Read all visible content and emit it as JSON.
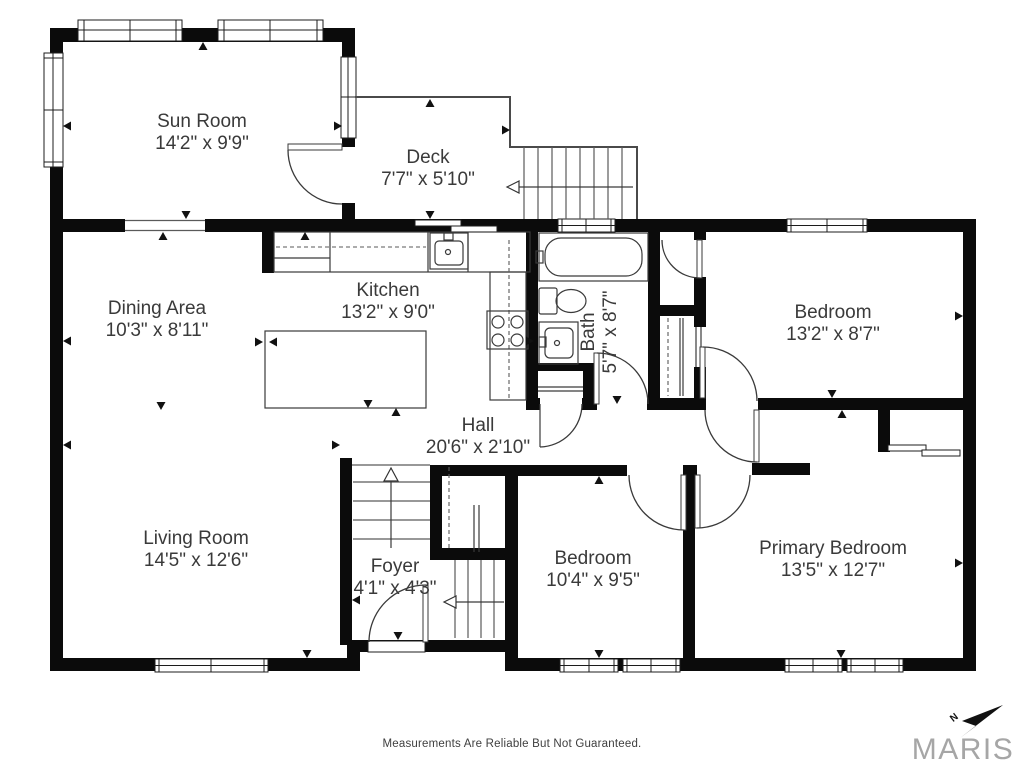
{
  "plan": {
    "rooms": {
      "sun_room": {
        "name": "Sun Room",
        "dims": "14'2\" x 9'9\""
      },
      "deck": {
        "name": "Deck",
        "dims": "7'7\" x 5'10\""
      },
      "dining_area": {
        "name": "Dining Area",
        "dims": "10'3\" x 8'11\""
      },
      "kitchen": {
        "name": "Kitchen",
        "dims": "13'2\" x 9'0\""
      },
      "bath": {
        "name": "Bath",
        "dims": "5'7\" x 8'7\""
      },
      "bedroom_upper": {
        "name": "Bedroom",
        "dims": "13'2\" x 8'7\""
      },
      "hall": {
        "name": "Hall",
        "dims": "20'6\" x 2'10\""
      },
      "living_room": {
        "name": "Living Room",
        "dims": "14'5\" x 12'6\""
      },
      "foyer": {
        "name": "Foyer",
        "dims": "4'1\" x 4'3\""
      },
      "bedroom_lower": {
        "name": "Bedroom",
        "dims": "10'4\" x 9'5\""
      },
      "primary_bedroom": {
        "name": "Primary Bedroom",
        "dims": "13'5\" x 12'7\""
      }
    },
    "compass_label": "N"
  },
  "footer": {
    "disclaimer": "Measurements Are Reliable But Not Guaranteed.",
    "brand": "MARIS"
  }
}
